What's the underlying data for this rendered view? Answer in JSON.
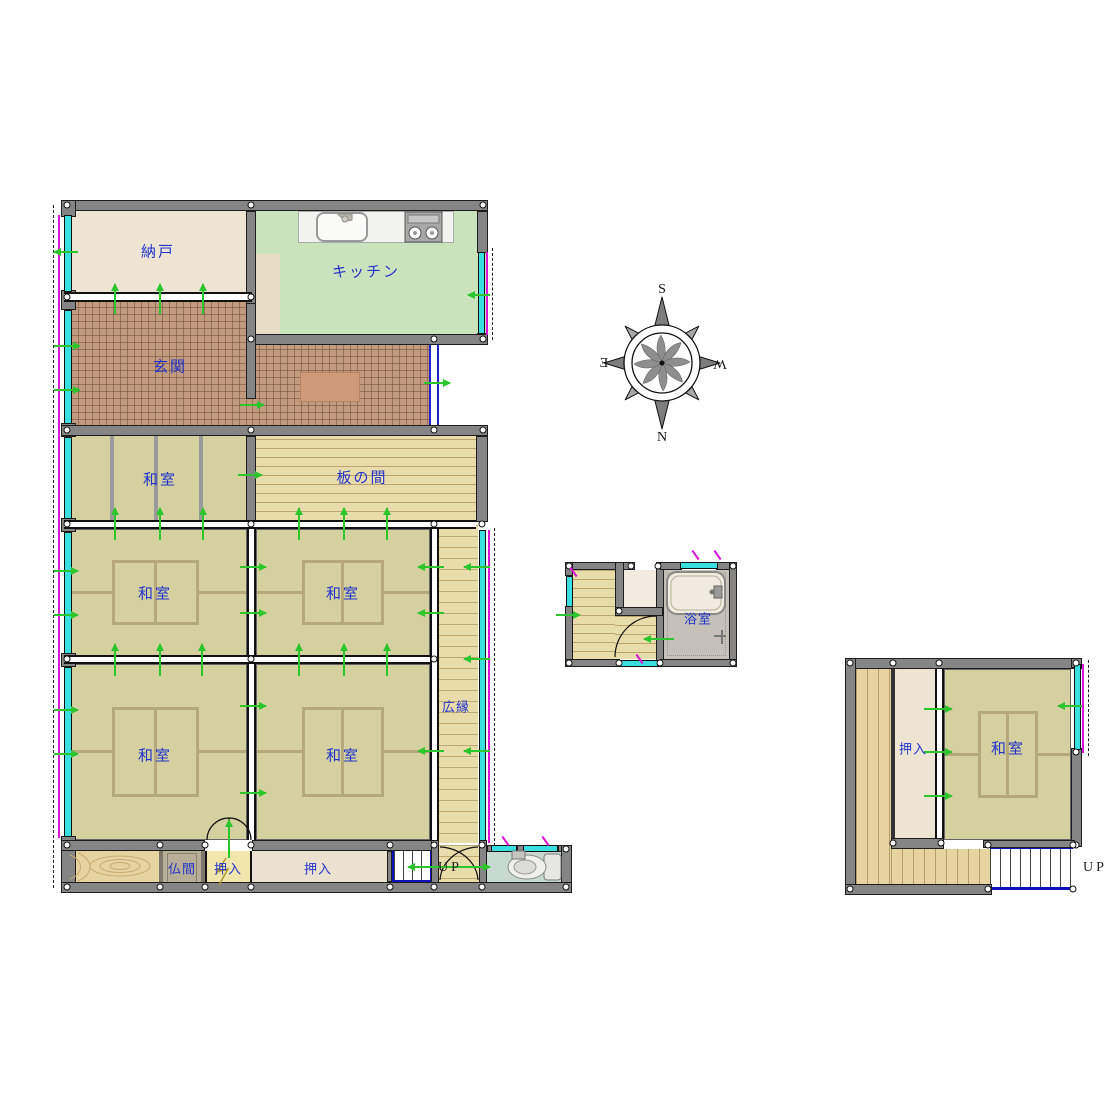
{
  "labels": {
    "nando": "納戸",
    "kitchen": "キッチン",
    "genkan": "玄関",
    "washitsu": "和室",
    "itanoma": "板の間",
    "hiroen": "広縁",
    "butsuma": "仏間",
    "oshiire": "押入",
    "yokushitsu": "浴室",
    "up": "UP"
  },
  "compass": {
    "s": "S",
    "w": "W",
    "n": "N",
    "e": "E"
  },
  "colors": {
    "tatami": "#d4d0a0",
    "wood_floor": "#e8dcab",
    "entry_tile": "#c29a7e",
    "kitchen_floor": "#cbe3bd",
    "storage_floor": "#ede4d3",
    "closet_yellow": "#f1e7ac",
    "butsuma_floor": "#b7ae98",
    "toilet_floor": "#c7dad1",
    "bath_floor": "#c5c1b9",
    "wall_gray": "#858585",
    "label_blue": "#2233cc",
    "arrow_green": "#2dc52d",
    "window_cyan": "#3ae0e0",
    "window_magenta": "#d816d8",
    "stair_blue": "#1111bb"
  }
}
